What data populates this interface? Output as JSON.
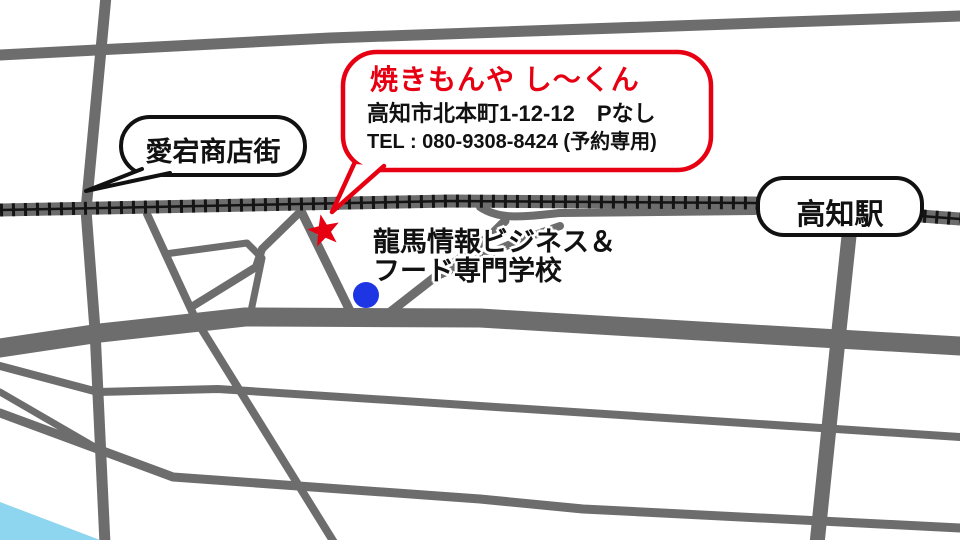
{
  "map": {
    "callout": {
      "title": "焼きもんや し〜くん",
      "address": "高知市北本町1-12-12　Pなし",
      "tel": "TEL : 080-9308-8424 (予約専用)"
    },
    "labels": {
      "shopping_street": "愛宕商店街",
      "station": "高知駅",
      "school_line1": "龍馬情報ビジネス＆",
      "school_line2": "フード専門学校"
    },
    "markers": {
      "shop_marker": "red-star",
      "school_marker": "blue-dot"
    },
    "colors": {
      "callout_red": "#e60012",
      "road_gray": "#6d6d6d",
      "railway_black": "#141414",
      "river_blue": "#8ed6ef",
      "school_dot_blue": "#1d35e3",
      "bubble_border_black": "#111111"
    }
  }
}
